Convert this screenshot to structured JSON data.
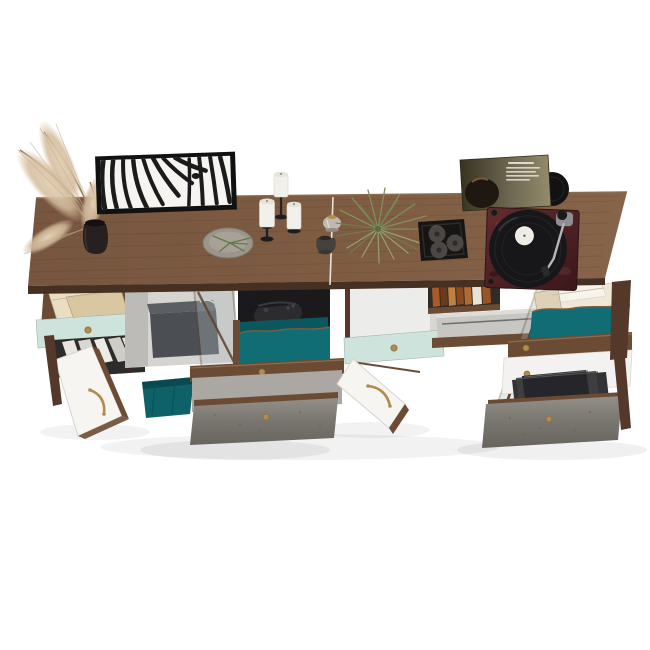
{
  "title": "Walnut sideboard product render",
  "colors": {
    "background": "#ffffff",
    "wood_top": "#7c5a40",
    "wood_mid": "#6b4b33",
    "wood_dark": "#54392a",
    "wood_edge": "#463022",
    "mint": "#cfe3dd",
    "teal": "#0f6d73",
    "teal_dark": "#0a575d",
    "basket_teal": "#0d6167",
    "white_panel": "#f3f2f0",
    "door_white": "#f6f5f2",
    "interior_light": "#e9e7e4",
    "interior_gray": "#d6d4d1",
    "interior_dark": "#1a1a1c",
    "slate_box": "#4b4f54",
    "console_silver": "#c7c6c3",
    "brass": "#b08d4f",
    "frame_black": "#111111",
    "mat_white": "#f5f4f1",
    "stripe_black": "#1b1b1b",
    "plate_gray": "#9b958c",
    "candle_white": "#f2f0ea",
    "metal_black": "#1d1d1d",
    "plume_tan": "#d7c2a6",
    "plant_green": "#7f8f5e",
    "tray_black": "#171514",
    "tray_candle_gray": "#4a4744",
    "vinyl_black": "#121212",
    "label_white": "#efece6",
    "plinth_burgundy": "#572628",
    "platter_black": "#17171a",
    "paper_cream": "#efe8d6",
    "records_dark": "#333335",
    "concrete_light": "#908c86",
    "concrete_dark": "#6e6a64",
    "book_cream": "#e9dec2",
    "book_tan": "#d9c7a2"
  },
  "scene": {
    "background": "#ffffff",
    "furniture": "two-module walnut sideboard with open drawers and doors",
    "decor": [
      "pampas grass in black vase",
      "framed zebra art print",
      "ceramic plate with green sprig",
      "three pillar candles on black holders",
      "glass votive and small dark vase",
      "air plant",
      "black tray with three candles",
      "vinyl record sleeve with record",
      "turntable playing a record"
    ],
    "storage": [
      "mint drawer with books",
      "shelf with binders",
      "white cabinet door (open)",
      "media compartment with slate box",
      "glass door (open)",
      "compartment with game controller",
      "teal drawer (open)",
      "teal fabric basket",
      "concrete-front bottom drawer",
      "empty mint drawer",
      "book shelf row",
      "silver game console",
      "teal drawer with papers",
      "white drawer",
      "drawer with vinyl records"
    ]
  }
}
